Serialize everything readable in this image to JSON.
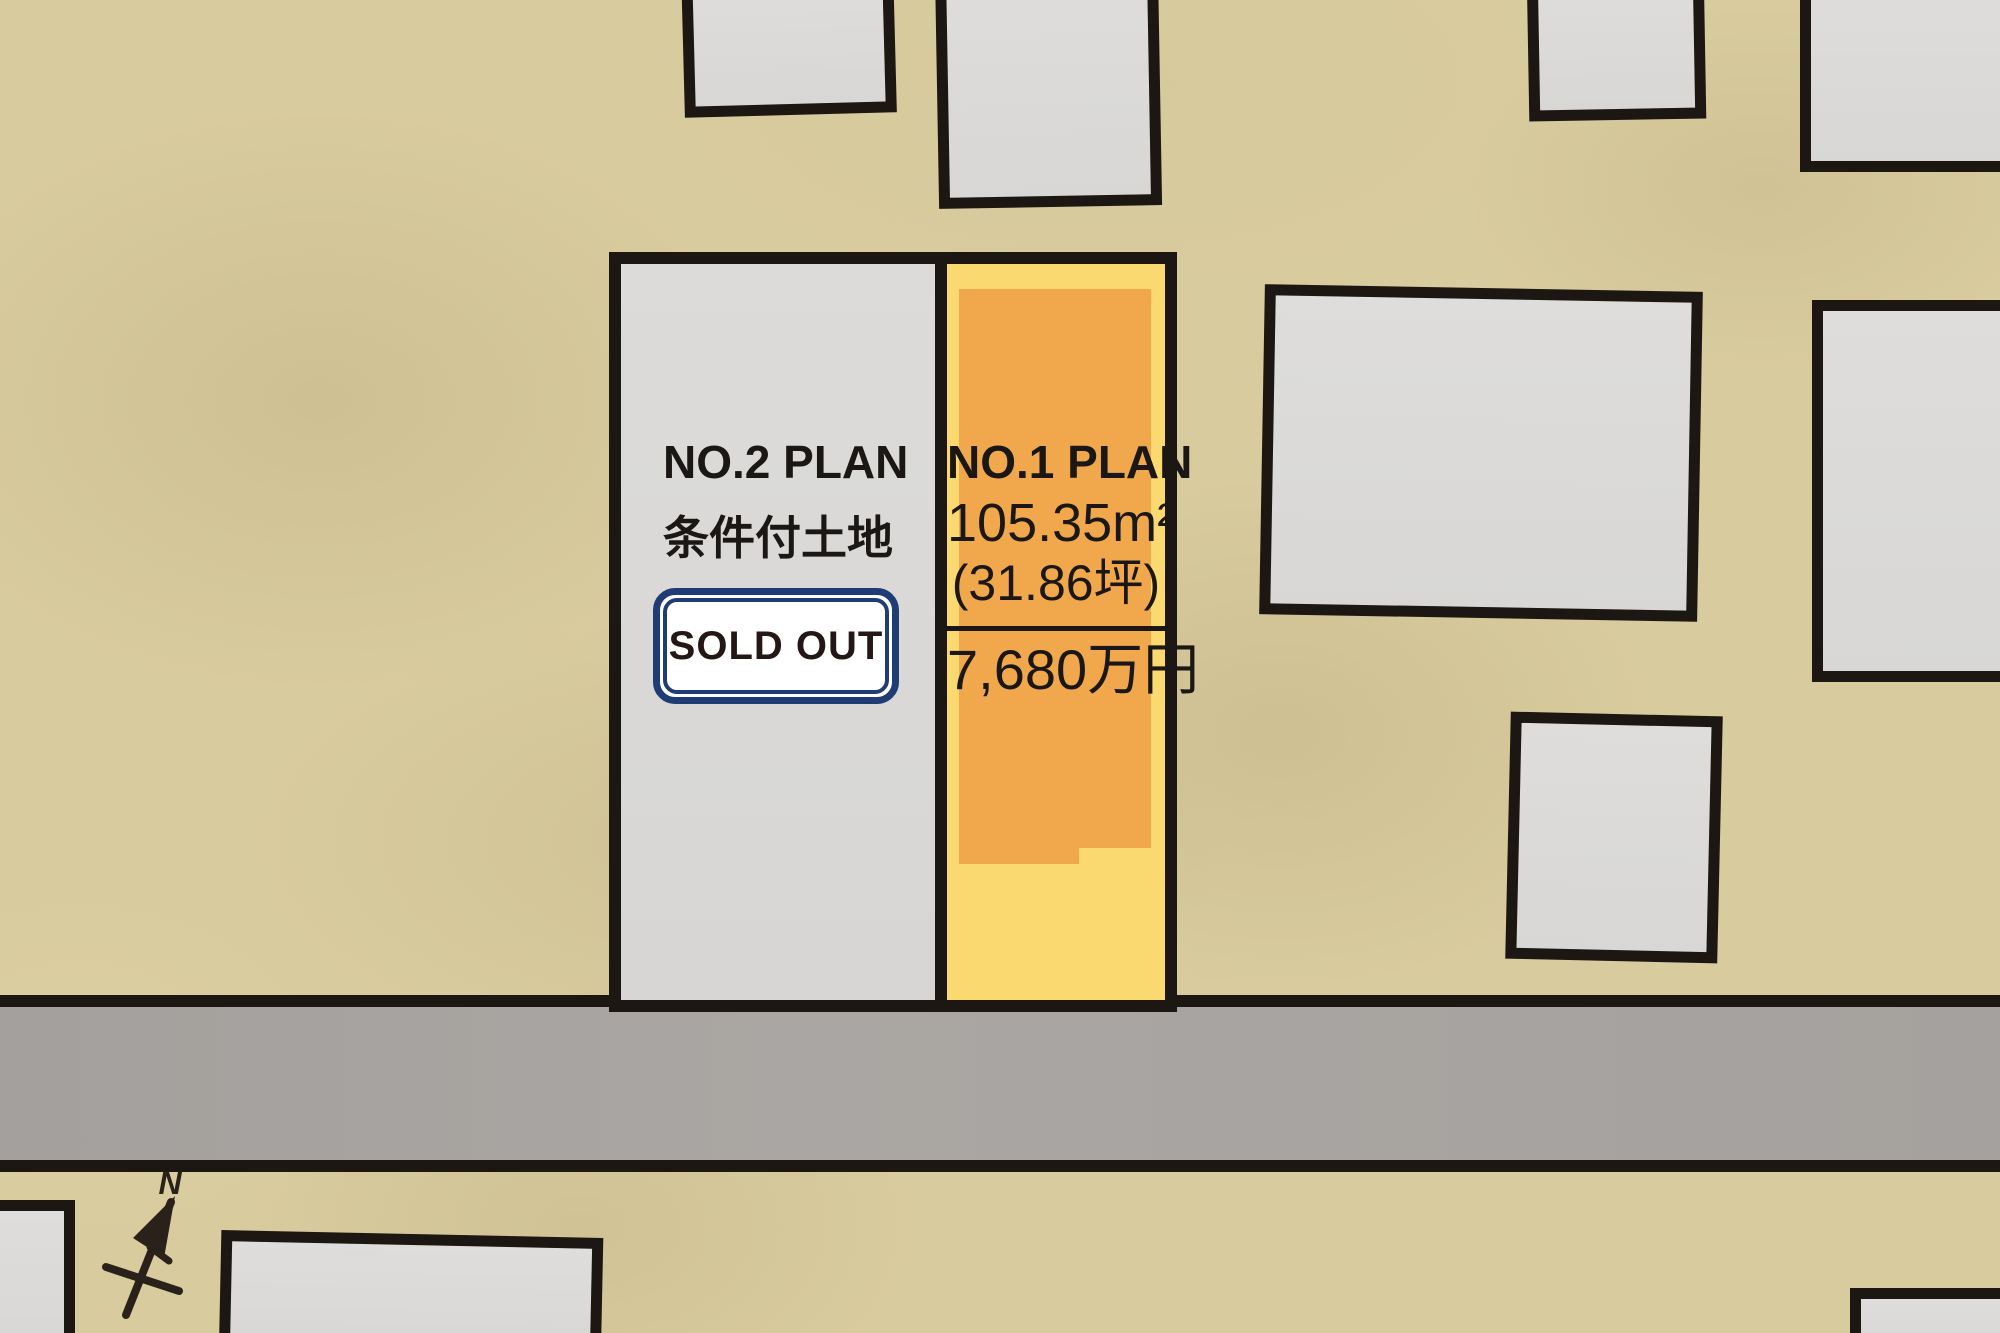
{
  "compass": {
    "label": "N"
  },
  "plots": {
    "no2": {
      "label": "NO.2 PLAN",
      "condition": "条件付土地",
      "badge": "SOLD OUT"
    },
    "no1": {
      "label": "NO.1 PLAN",
      "area_m2": "105.35m²",
      "area_tsubo": "(31.86坪)",
      "price": "7,680万円"
    }
  },
  "colors": {
    "background": "#d8cb9d",
    "road": "#a7a3a0",
    "outline": "#1c1713",
    "building_fill": "#dbdad8",
    "plot2_fill": "#d9d8d6",
    "plot1_fill": "#fbd971",
    "plot1_inner": "#f1a84d",
    "badge_border": "#203c74",
    "badge_bg": "#ffffff",
    "text": "#1a1714"
  }
}
